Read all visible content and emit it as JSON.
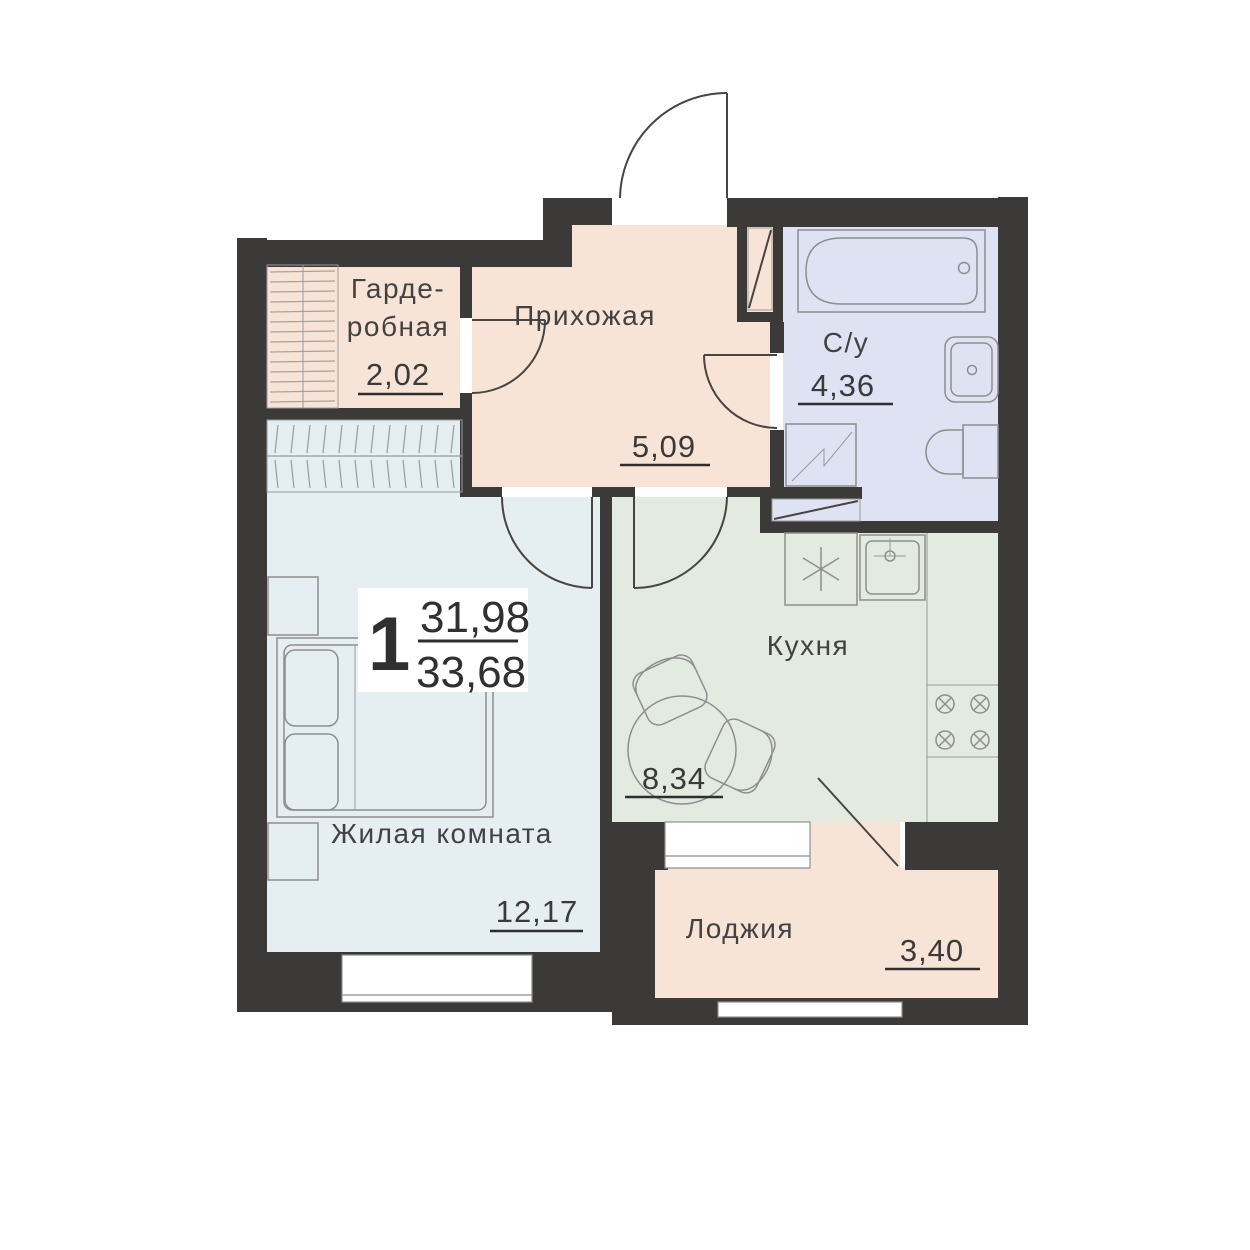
{
  "plan": {
    "unit_label": "1",
    "area_living": "31,98",
    "area_total": "33,68",
    "rooms": {
      "wardrobe": {
        "name_line1": "Гарде-",
        "name_line2": "робная",
        "area": "2,02"
      },
      "hallway": {
        "name": "Прихожая",
        "area": "5,09"
      },
      "bathroom": {
        "name": "С/у",
        "area": "4,36"
      },
      "kitchen": {
        "name": "Кухня",
        "area": "8,34"
      },
      "living": {
        "name": "Жилая комната",
        "area": "12,17"
      },
      "loggia": {
        "name": "Лоджия",
        "area": "3,40"
      }
    },
    "colors": {
      "wall": "#3c3a39",
      "hallway": "#f7e4d6",
      "wardrobe": "#f7e4d6",
      "loggia": "#f7e4d6",
      "living": "#e5eef0",
      "kitchen": "#e3eae0",
      "bathroom": "#dfe2f3"
    }
  }
}
